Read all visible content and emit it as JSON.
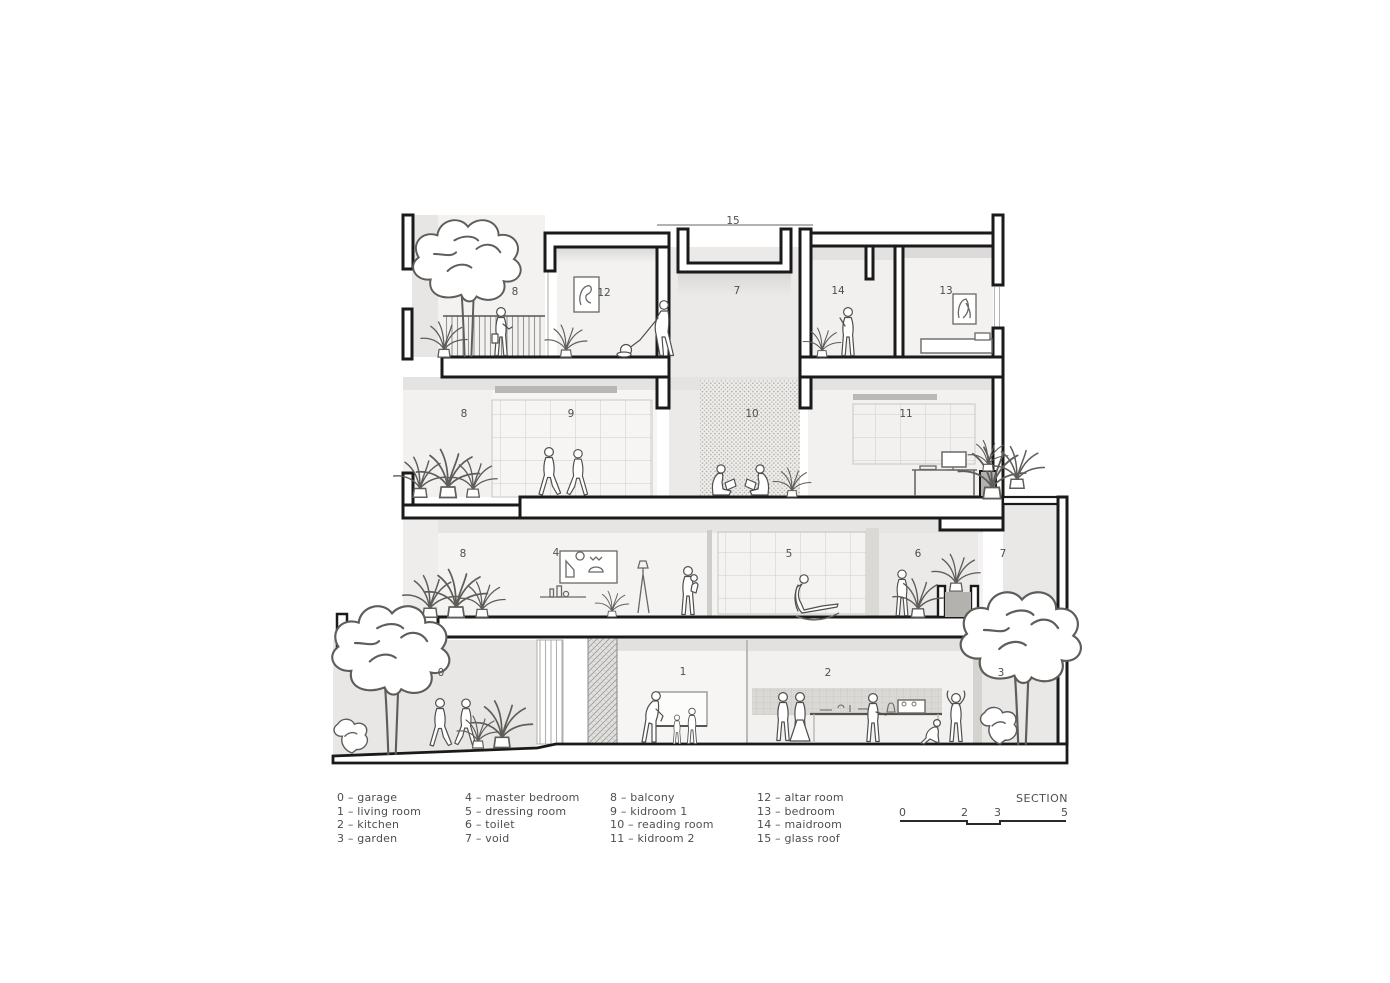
{
  "drawing": {
    "room_labels": [
      "15",
      "7",
      "8",
      "12",
      "14",
      "13",
      "8",
      "9",
      "10",
      "11",
      "8",
      "4",
      "5",
      "6",
      "7",
      "0",
      "1",
      "2",
      "3"
    ]
  },
  "legend": {
    "columns": [
      {
        "items": [
          "0 – garage",
          "1 – living room",
          "2 – kitchen",
          "3 – garden"
        ]
      },
      {
        "items": [
          "4 – master bedroom",
          "5 – dressing room",
          "6 – toilet",
          "7 – void"
        ]
      },
      {
        "items": [
          "8 – balcony",
          "9 – kidroom 1",
          "10 – reading room",
          "11 – kidroom 2"
        ]
      },
      {
        "items": [
          "12 – altar room",
          "13 – bedroom",
          "14 – maidroom",
          "15 – glass roof"
        ]
      }
    ]
  },
  "scale_bar": {
    "title": "SECTION",
    "ticks": [
      "0",
      "2",
      "3",
      "5"
    ]
  },
  "colors": {
    "ink": "#1a1a1a",
    "label": "#4f4f4f",
    "wash_light": "#f3f2f0",
    "wash_mid": "#e5e4e2",
    "planter_fill": "#b4b2af"
  }
}
